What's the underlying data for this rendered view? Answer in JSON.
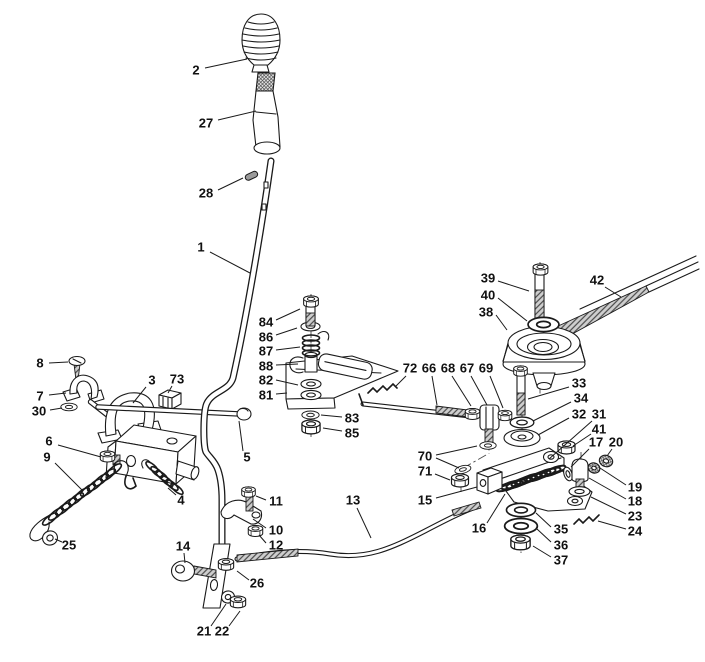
{
  "meta": {
    "background_color": "#ffffff",
    "line_color": "#1a1a1a",
    "diagram_type": "exploded-parts-diagram",
    "subject": "gear lever and clutch engagement linkage"
  },
  "diagram": {
    "labels": [
      {
        "t": "2",
        "x": 196,
        "y": 71,
        "l": [
          [
            205,
            68,
            247,
            59
          ]
        ]
      },
      {
        "t": "27",
        "x": 206,
        "y": 124,
        "l": [
          [
            218,
            120,
            256,
            111
          ]
        ]
      },
      {
        "t": "28",
        "x": 206,
        "y": 194,
        "l": [
          [
            218,
            190,
            243,
            178
          ]
        ]
      },
      {
        "t": "1",
        "x": 201,
        "y": 248,
        "l": [
          [
            210,
            252,
            250,
            273
          ]
        ]
      },
      {
        "t": "84",
        "x": 266,
        "y": 323,
        "l": [
          [
            276,
            320,
            300,
            309
          ]
        ]
      },
      {
        "t": "86",
        "x": 266,
        "y": 338,
        "l": [
          [
            276,
            335,
            297,
            328
          ]
        ]
      },
      {
        "t": "87",
        "x": 266,
        "y": 352,
        "l": [
          [
            276,
            350,
            300,
            347
          ]
        ]
      },
      {
        "t": "88",
        "x": 266,
        "y": 367,
        "l": [
          [
            276,
            365,
            298,
            364
          ]
        ]
      },
      {
        "t": "82",
        "x": 266,
        "y": 381,
        "l": [
          [
            276,
            380,
            298,
            385
          ]
        ]
      },
      {
        "t": "81",
        "x": 266,
        "y": 396,
        "l": [
          [
            276,
            394,
            287,
            393
          ]
        ]
      },
      {
        "t": "83",
        "x": 352,
        "y": 419,
        "l": [
          [
            342,
            417,
            321,
            415
          ]
        ]
      },
      {
        "t": "85",
        "x": 352,
        "y": 434,
        "l": [
          [
            342,
            431,
            323,
            428
          ]
        ]
      },
      {
        "t": "72",
        "x": 410,
        "y": 369,
        "l": [
          [
            406,
            376,
            396,
            386
          ]
        ]
      },
      {
        "t": "66",
        "x": 429,
        "y": 369,
        "l": [
          [
            432,
            376,
            437,
            405
          ]
        ]
      },
      {
        "t": "68",
        "x": 448,
        "y": 369,
        "l": [
          [
            452,
            376,
            471,
            406
          ]
        ]
      },
      {
        "t": "67",
        "x": 467,
        "y": 369,
        "l": [
          [
            471,
            376,
            487,
            405
          ]
        ]
      },
      {
        "t": "69",
        "x": 486,
        "y": 369,
        "l": [
          [
            490,
            376,
            503,
            408
          ]
        ]
      },
      {
        "t": "8",
        "x": 40,
        "y": 364,
        "l": [
          [
            49,
            363,
            68,
            362
          ]
        ]
      },
      {
        "t": "7",
        "x": 40,
        "y": 397,
        "l": [
          [
            49,
            395,
            66,
            393
          ]
        ]
      },
      {
        "t": "30",
        "x": 39,
        "y": 412,
        "l": [
          [
            50,
            410,
            62,
            408
          ]
        ]
      },
      {
        "t": "3",
        "x": 152,
        "y": 381,
        "l": [
          [
            146,
            387,
            133,
            403
          ]
        ]
      },
      {
        "t": "73",
        "x": 177,
        "y": 380,
        "l": [
          [
            172,
            386,
            168,
            393
          ]
        ]
      },
      {
        "t": "6",
        "x": 49,
        "y": 442,
        "l": [
          [
            58,
            445,
            101,
            457
          ]
        ]
      },
      {
        "t": "9",
        "x": 47,
        "y": 458,
        "l": [
          [
            55,
            463,
            82,
            490
          ]
        ]
      },
      {
        "t": "25",
        "x": 69,
        "y": 546,
        "l": [
          [
            62,
            542,
            55,
            539
          ]
        ]
      },
      {
        "t": "5",
        "x": 247,
        "y": 458,
        "l": [
          [
            243,
            451,
            239,
            421
          ]
        ]
      },
      {
        "t": "4",
        "x": 181,
        "y": 501,
        "l": [
          [
            176,
            495,
            168,
            488
          ]
        ]
      },
      {
        "t": "14",
        "x": 183,
        "y": 547,
        "l": [
          [
            184,
            553,
            185,
            563
          ]
        ]
      },
      {
        "t": "26",
        "x": 257,
        "y": 584,
        "l": [
          [
            249,
            580,
            237,
            571
          ]
        ]
      },
      {
        "t": "21",
        "x": 204,
        "y": 632,
        "l": [
          [
            211,
            626,
            226,
            604
          ]
        ]
      },
      {
        "t": "22",
        "x": 222,
        "y": 632,
        "l": [
          [
            229,
            626,
            240,
            611
          ]
        ]
      },
      {
        "t": "11",
        "x": 276,
        "y": 502,
        "l": [
          [
            266,
            500,
            256,
            496
          ]
        ]
      },
      {
        "t": "10",
        "x": 276,
        "y": 531,
        "l": [
          [
            266,
            528,
            253,
            519
          ]
        ]
      },
      {
        "t": "12",
        "x": 276,
        "y": 546,
        "l": [
          [
            266,
            543,
            259,
            535
          ]
        ]
      },
      {
        "t": "13",
        "x": 353,
        "y": 501,
        "l": [
          [
            357,
            508,
            371,
            538
          ]
        ]
      },
      {
        "t": "15",
        "x": 425,
        "y": 501,
        "l": [
          [
            436,
            498,
            477,
            487
          ]
        ]
      },
      {
        "t": "16",
        "x": 479,
        "y": 529,
        "l": [
          [
            487,
            523,
            505,
            494
          ]
        ]
      },
      {
        "t": "35",
        "x": 561,
        "y": 530,
        "l": [
          [
            551,
            527,
            536,
            513
          ]
        ]
      },
      {
        "t": "36",
        "x": 561,
        "y": 546,
        "l": [
          [
            551,
            542,
            537,
            529
          ]
        ]
      },
      {
        "t": "37",
        "x": 561,
        "y": 561,
        "l": [
          [
            551,
            557,
            533,
            546
          ]
        ]
      },
      {
        "t": "70",
        "x": 425,
        "y": 457,
        "l": [
          [
            436,
            455,
            477,
            446
          ],
          [
            436,
            458,
            459,
            468
          ]
        ]
      },
      {
        "t": "71",
        "x": 425,
        "y": 472,
        "l": [
          [
            435,
            474,
            450,
            480
          ]
        ]
      },
      {
        "t": "39",
        "x": 488,
        "y": 279,
        "l": [
          [
            498,
            281,
            529,
            291
          ]
        ]
      },
      {
        "t": "40",
        "x": 488,
        "y": 296,
        "l": [
          [
            498,
            298,
            527,
            321
          ]
        ]
      },
      {
        "t": "38",
        "x": 486,
        "y": 313,
        "l": [
          [
            496,
            315,
            507,
            330
          ]
        ]
      },
      {
        "t": "42",
        "x": 597,
        "y": 281,
        "l": [
          [
            605,
            287,
            621,
            297
          ]
        ]
      },
      {
        "t": "33",
        "x": 579,
        "y": 384,
        "l": [
          [
            569,
            387,
            528,
            399
          ]
        ]
      },
      {
        "t": "34",
        "x": 581,
        "y": 399,
        "l": [
          [
            571,
            402,
            533,
            421
          ]
        ]
      },
      {
        "t": "32",
        "x": 579,
        "y": 415,
        "l": [
          [
            569,
            418,
            538,
            435
          ]
        ]
      },
      {
        "t": "31",
        "x": 599,
        "y": 415,
        "l": [
          [
            592,
            421,
            549,
            459
          ]
        ]
      },
      {
        "t": "41",
        "x": 599,
        "y": 430,
        "l": [
          [
            591,
            434,
            573,
            446
          ]
        ]
      },
      {
        "t": "17",
        "x": 596,
        "y": 443,
        "l": [
          [
            589,
            449,
            571,
            467
          ]
        ]
      },
      {
        "t": "20",
        "x": 616,
        "y": 443,
        "l": [
          [
            612,
            449,
            607,
            456
          ]
        ]
      },
      {
        "t": "19",
        "x": 635,
        "y": 488,
        "l": [
          [
            626,
            485,
            600,
            468
          ]
        ]
      },
      {
        "t": "18",
        "x": 635,
        "y": 502,
        "l": [
          [
            626,
            499,
            589,
            478
          ]
        ]
      },
      {
        "t": "23",
        "x": 635,
        "y": 517,
        "l": [
          [
            626,
            514,
            591,
            497
          ]
        ]
      },
      {
        "t": "24",
        "x": 635,
        "y": 532,
        "l": [
          [
            626,
            529,
            598,
            521
          ]
        ]
      }
    ]
  }
}
